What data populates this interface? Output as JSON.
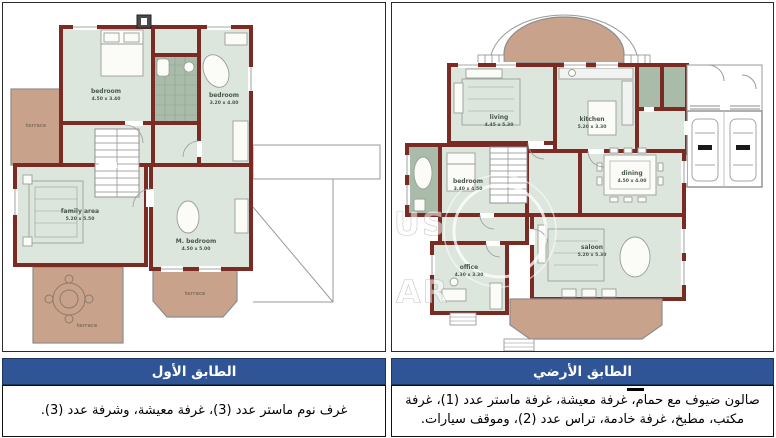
{
  "panels": {
    "left": {
      "title": "الطابق الأول",
      "description": "غرف نوم ماستر عدد (3)، غرفة معيشة، وشرفة عدد (3).",
      "rooms": [
        {
          "name": "bedroom",
          "dims": "4.50 x 3.40"
        },
        {
          "name": "bedroom",
          "dims": "3.20 x 4.80"
        },
        {
          "name": "family area",
          "dims": "5.20 x 5.50"
        },
        {
          "name": "M. bedroom",
          "dims": "4.50 x 5.00"
        },
        {
          "name": "terrace",
          "dims": ""
        },
        {
          "name": "terrace",
          "dims": ""
        },
        {
          "name": "terrace",
          "dims": ""
        }
      ]
    },
    "right": {
      "title": "الطابق الأرضي",
      "description": "صالون ضيوف مع حمام، غرفة معيشة، غرفة ماستر عدد (1)، غرفة مكتب، مطبخ، غرفة خادمة، تراس عدد (2)، وموقف سيارات.",
      "rooms": [
        {
          "name": "living",
          "dims": "4.45 x 5.30"
        },
        {
          "name": "kitchen",
          "dims": "5.20 x 3.30"
        },
        {
          "name": "bedroom",
          "dims": "3.40 x 4.50"
        },
        {
          "name": "dining",
          "dims": "4.50 x 4.00"
        },
        {
          "name": "saloon",
          "dims": "5.20 x 5.30"
        },
        {
          "name": "office",
          "dims": "4.30 x 3.30"
        }
      ]
    }
  },
  "watermark": {
    "letters_top": "US",
    "letters_bottom": "AR"
  },
  "colors": {
    "header_bg": "#2F5597",
    "header_text": "#FFFFFF",
    "wall": "#7A2B24",
    "room_fill": "#DDE6DD",
    "tile_fill": "#A9BCA9",
    "terrace_fill": "#C9A28C",
    "label_text": "#47584A"
  }
}
